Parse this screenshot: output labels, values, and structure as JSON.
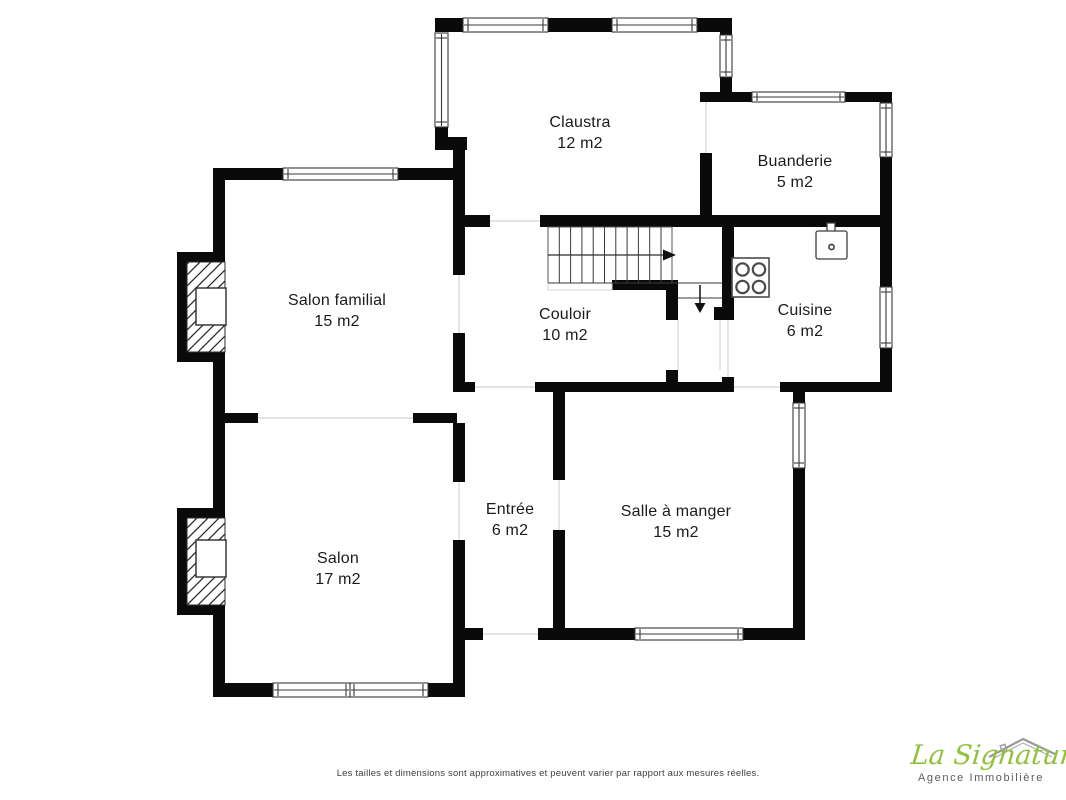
{
  "plan": {
    "rooms": [
      {
        "name": "Claustra",
        "area": "12 m2",
        "x": 580,
        "y": 112
      },
      {
        "name": "Buanderie",
        "area": "5 m2",
        "x": 795,
        "y": 151
      },
      {
        "name": "Salon familial",
        "area": "15 m2",
        "x": 337,
        "y": 290
      },
      {
        "name": "Couloir",
        "area": "10 m2",
        "x": 565,
        "y": 304
      },
      {
        "name": "Cuisine",
        "area": "6 m2",
        "x": 805,
        "y": 300
      },
      {
        "name": "Entrée",
        "area": "6 m2",
        "x": 510,
        "y": 499
      },
      {
        "name": "Salle à manger",
        "area": "15 m2",
        "x": 676,
        "y": 501
      },
      {
        "name": "Salon",
        "area": "17 m2",
        "x": 338,
        "y": 548
      }
    ],
    "fixtures": [
      "staircase-up-arrow",
      "staircase-down-arrow",
      "stove-4-burners",
      "kitchen-sink",
      "fireplace-upper",
      "fireplace-lower"
    ]
  },
  "footer": {
    "disclaimer": "Les tailles et dimensions sont approximatives et peuvent varier par rapport aux mesures réelles.",
    "logo": {
      "brand": "La Signature",
      "tagline": "Agence Immobilière",
      "brand_color": "#92c13c",
      "tagline_color": "#5b5b5b"
    }
  },
  "colors": {
    "wall": "#0a0a0a",
    "background": "#ffffff",
    "label": "#1b1b1b",
    "thin_line": "#d4d4d4"
  }
}
